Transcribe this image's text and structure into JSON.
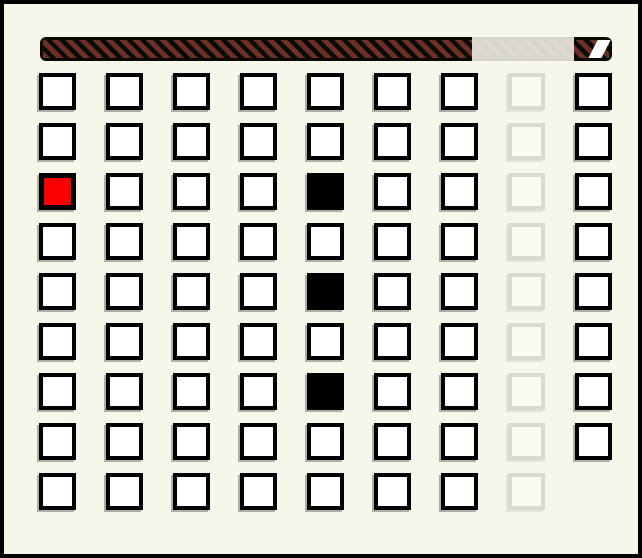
{
  "window": {
    "width": 642,
    "height": 558,
    "background_color": "#f7f6eb",
    "frame_color": "#000000"
  },
  "timer_bar": {
    "bar_color": "#0b0b06",
    "stripe_color": "#6e2f26",
    "stripe_direction": "diagonal-forward-slash",
    "highlight_overlay": {
      "color": "#ecebE4",
      "start_pct": 75.5,
      "width_pct": 17.8
    },
    "end_marker_color": "#ffffff"
  },
  "grid": {
    "rows": 9,
    "cols": 9,
    "cell_colors": {
      "normal_fill": "#ffffff",
      "normal_border": "#000000",
      "red_fill": "#fa0000",
      "black_fill": "#000000",
      "faded_border": "#dbdacf",
      "faded_fill": "#fcfbf3"
    },
    "legend": {
      "n": "normal",
      "r": "red",
      "b": "black",
      "f": "faded",
      "x": "missing"
    },
    "cell_states": [
      [
        "n",
        "n",
        "n",
        "n",
        "n",
        "n",
        "n",
        "f",
        "n"
      ],
      [
        "n",
        "n",
        "n",
        "n",
        "n",
        "n",
        "n",
        "f",
        "n"
      ],
      [
        "r",
        "n",
        "n",
        "n",
        "b",
        "n",
        "n",
        "f",
        "n"
      ],
      [
        "n",
        "n",
        "n",
        "n",
        "n",
        "n",
        "n",
        "f",
        "n"
      ],
      [
        "n",
        "n",
        "n",
        "n",
        "b",
        "n",
        "n",
        "f",
        "n"
      ],
      [
        "n",
        "n",
        "n",
        "n",
        "n",
        "n",
        "n",
        "f",
        "n"
      ],
      [
        "n",
        "n",
        "n",
        "n",
        "b",
        "n",
        "n",
        "f",
        "n"
      ],
      [
        "n",
        "n",
        "n",
        "n",
        "n",
        "n",
        "n",
        "f",
        "n"
      ],
      [
        "n",
        "n",
        "n",
        "n",
        "n",
        "n",
        "n",
        "f",
        "x"
      ]
    ]
  }
}
